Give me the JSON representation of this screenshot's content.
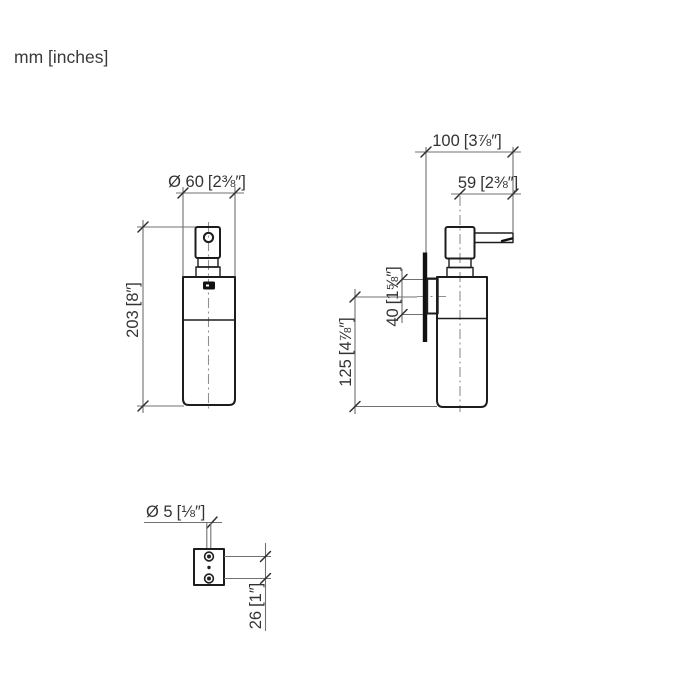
{
  "units_label": "mm [inches]",
  "colors": {
    "outline": "#1d1d1b",
    "dimension_lines": "#707070",
    "centerline": "#8f8f8f",
    "background": "#ffffff"
  },
  "front_view": {
    "diameter": {
      "mm": "Ø 60",
      "inches": "[2⅜″]"
    },
    "height": {
      "mm": "203",
      "inches": "[8″]"
    }
  },
  "side_view": {
    "total_depth": {
      "mm": "100",
      "inches": "[3⅞″]"
    },
    "spout_projection": {
      "mm": "59",
      "inches": "[2⅜″]"
    },
    "plate_height": {
      "mm": "40",
      "inches": "[1⅝″]"
    },
    "mounting_height": {
      "mm": "125",
      "inches": "[4⅞″]"
    }
  },
  "mounting_view": {
    "hole_diameter": {
      "mm": "Ø 5",
      "inches": "[⅛″]"
    },
    "hole_spacing": {
      "mm": "26",
      "inches": "[1″]"
    }
  }
}
